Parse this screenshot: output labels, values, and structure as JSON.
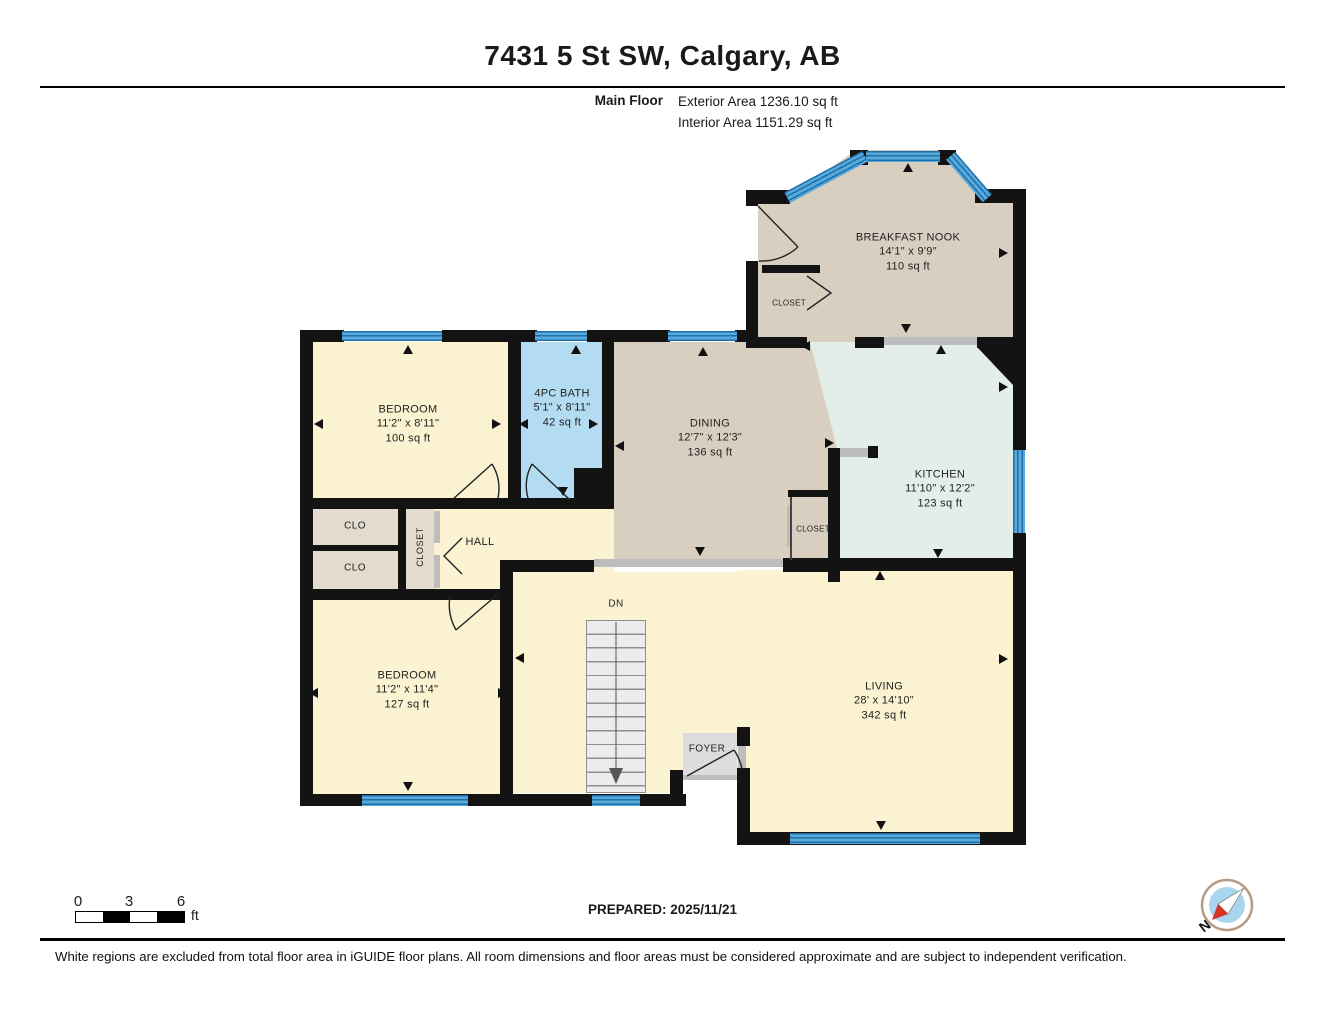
{
  "header": {
    "title": "7431 5 St SW, Calgary, AB",
    "floor_label": "Main Floor",
    "exterior_area": "Exterior Area 1236.10 sq ft",
    "interior_area": "Interior Area 1151.29 sq ft"
  },
  "rooms": {
    "breakfast_nook": {
      "name": "BREAKFAST NOOK",
      "dims": "14'1\" x 9'9\"",
      "area": "110 sq ft"
    },
    "bedroom_top": {
      "name": "BEDROOM",
      "dims": "11'2\" x 8'11\"",
      "area": "100 sq ft"
    },
    "bath": {
      "name": "4PC BATH",
      "dims": "5'1\" x 8'11\"",
      "area": "42 sq ft"
    },
    "dining": {
      "name": "DINING",
      "dims": "12'7\" x 12'3\"",
      "area": "136 sq ft"
    },
    "kitchen": {
      "name": "KITCHEN",
      "dims": "11'10\" x 12'2\"",
      "area": "123 sq ft"
    },
    "bedroom_bottom": {
      "name": "BEDROOM",
      "dims": "11'2\" x 11'4\"",
      "area": "127 sq ft"
    },
    "living": {
      "name": "LIVING",
      "dims": "28' x 14'10\"",
      "area": "342 sq ft"
    }
  },
  "labels": {
    "hall": "HALL",
    "foyer": "FOYER",
    "clo": "CLO",
    "closet": "CLOSET",
    "dn": "DN"
  },
  "scale_bar": {
    "ticks": [
      "0",
      "3",
      "6"
    ],
    "unit": "ft"
  },
  "compass": {
    "label": "N"
  },
  "footer": {
    "prepared": "PREPARED: 2025/11/21",
    "disclaimer": "White regions are excluded from total floor area in iGUIDE floor plans. All room dimensions and floor areas must be considered approximate and are subject to independent verification."
  },
  "colors": {
    "wall": "#131313",
    "cream": "#faf2d0",
    "tan": "#d9cfc1",
    "bath_blue": "#b3dcf2",
    "mint": "#e2eee7",
    "closet_gray": "#e2dbce",
    "foyer_gray": "#dcdcdc",
    "window_blue": "#58aadd",
    "window_line": "#1d6fa8",
    "threshold": "#bdbdbd",
    "stairs": "#ececec",
    "compass_red": "#d63324",
    "compass_blue": "#a9d5ef"
  },
  "arrows": [
    {
      "x": 408,
      "y": 350,
      "d": "up"
    },
    {
      "x": 319,
      "y": 424,
      "d": "left"
    },
    {
      "x": 497,
      "y": 424,
      "d": "right"
    },
    {
      "x": 524,
      "y": 424,
      "d": "left"
    },
    {
      "x": 594,
      "y": 424,
      "d": "right"
    },
    {
      "x": 576,
      "y": 350,
      "d": "up"
    },
    {
      "x": 703,
      "y": 352,
      "d": "up"
    },
    {
      "x": 620,
      "y": 446,
      "d": "left"
    },
    {
      "x": 700,
      "y": 552,
      "d": "down"
    },
    {
      "x": 806,
      "y": 346,
      "d": "left"
    },
    {
      "x": 830,
      "y": 443,
      "d": "right"
    },
    {
      "x": 908,
      "y": 168,
      "d": "up"
    },
    {
      "x": 1004,
      "y": 253,
      "d": "right"
    },
    {
      "x": 906,
      "y": 329,
      "d": "down"
    },
    {
      "x": 941,
      "y": 350,
      "d": "up"
    },
    {
      "x": 1004,
      "y": 387,
      "d": "right"
    },
    {
      "x": 938,
      "y": 554,
      "d": "down"
    },
    {
      "x": 880,
      "y": 576,
      "d": "up"
    },
    {
      "x": 1004,
      "y": 659,
      "d": "right"
    },
    {
      "x": 881,
      "y": 826,
      "d": "down"
    },
    {
      "x": 520,
      "y": 658,
      "d": "left"
    },
    {
      "x": 563,
      "y": 492,
      "d": "down"
    },
    {
      "x": 408,
      "y": 594,
      "d": "up"
    },
    {
      "x": 314,
      "y": 693,
      "d": "left"
    },
    {
      "x": 503,
      "y": 693,
      "d": "right"
    },
    {
      "x": 408,
      "y": 787,
      "d": "down"
    }
  ]
}
